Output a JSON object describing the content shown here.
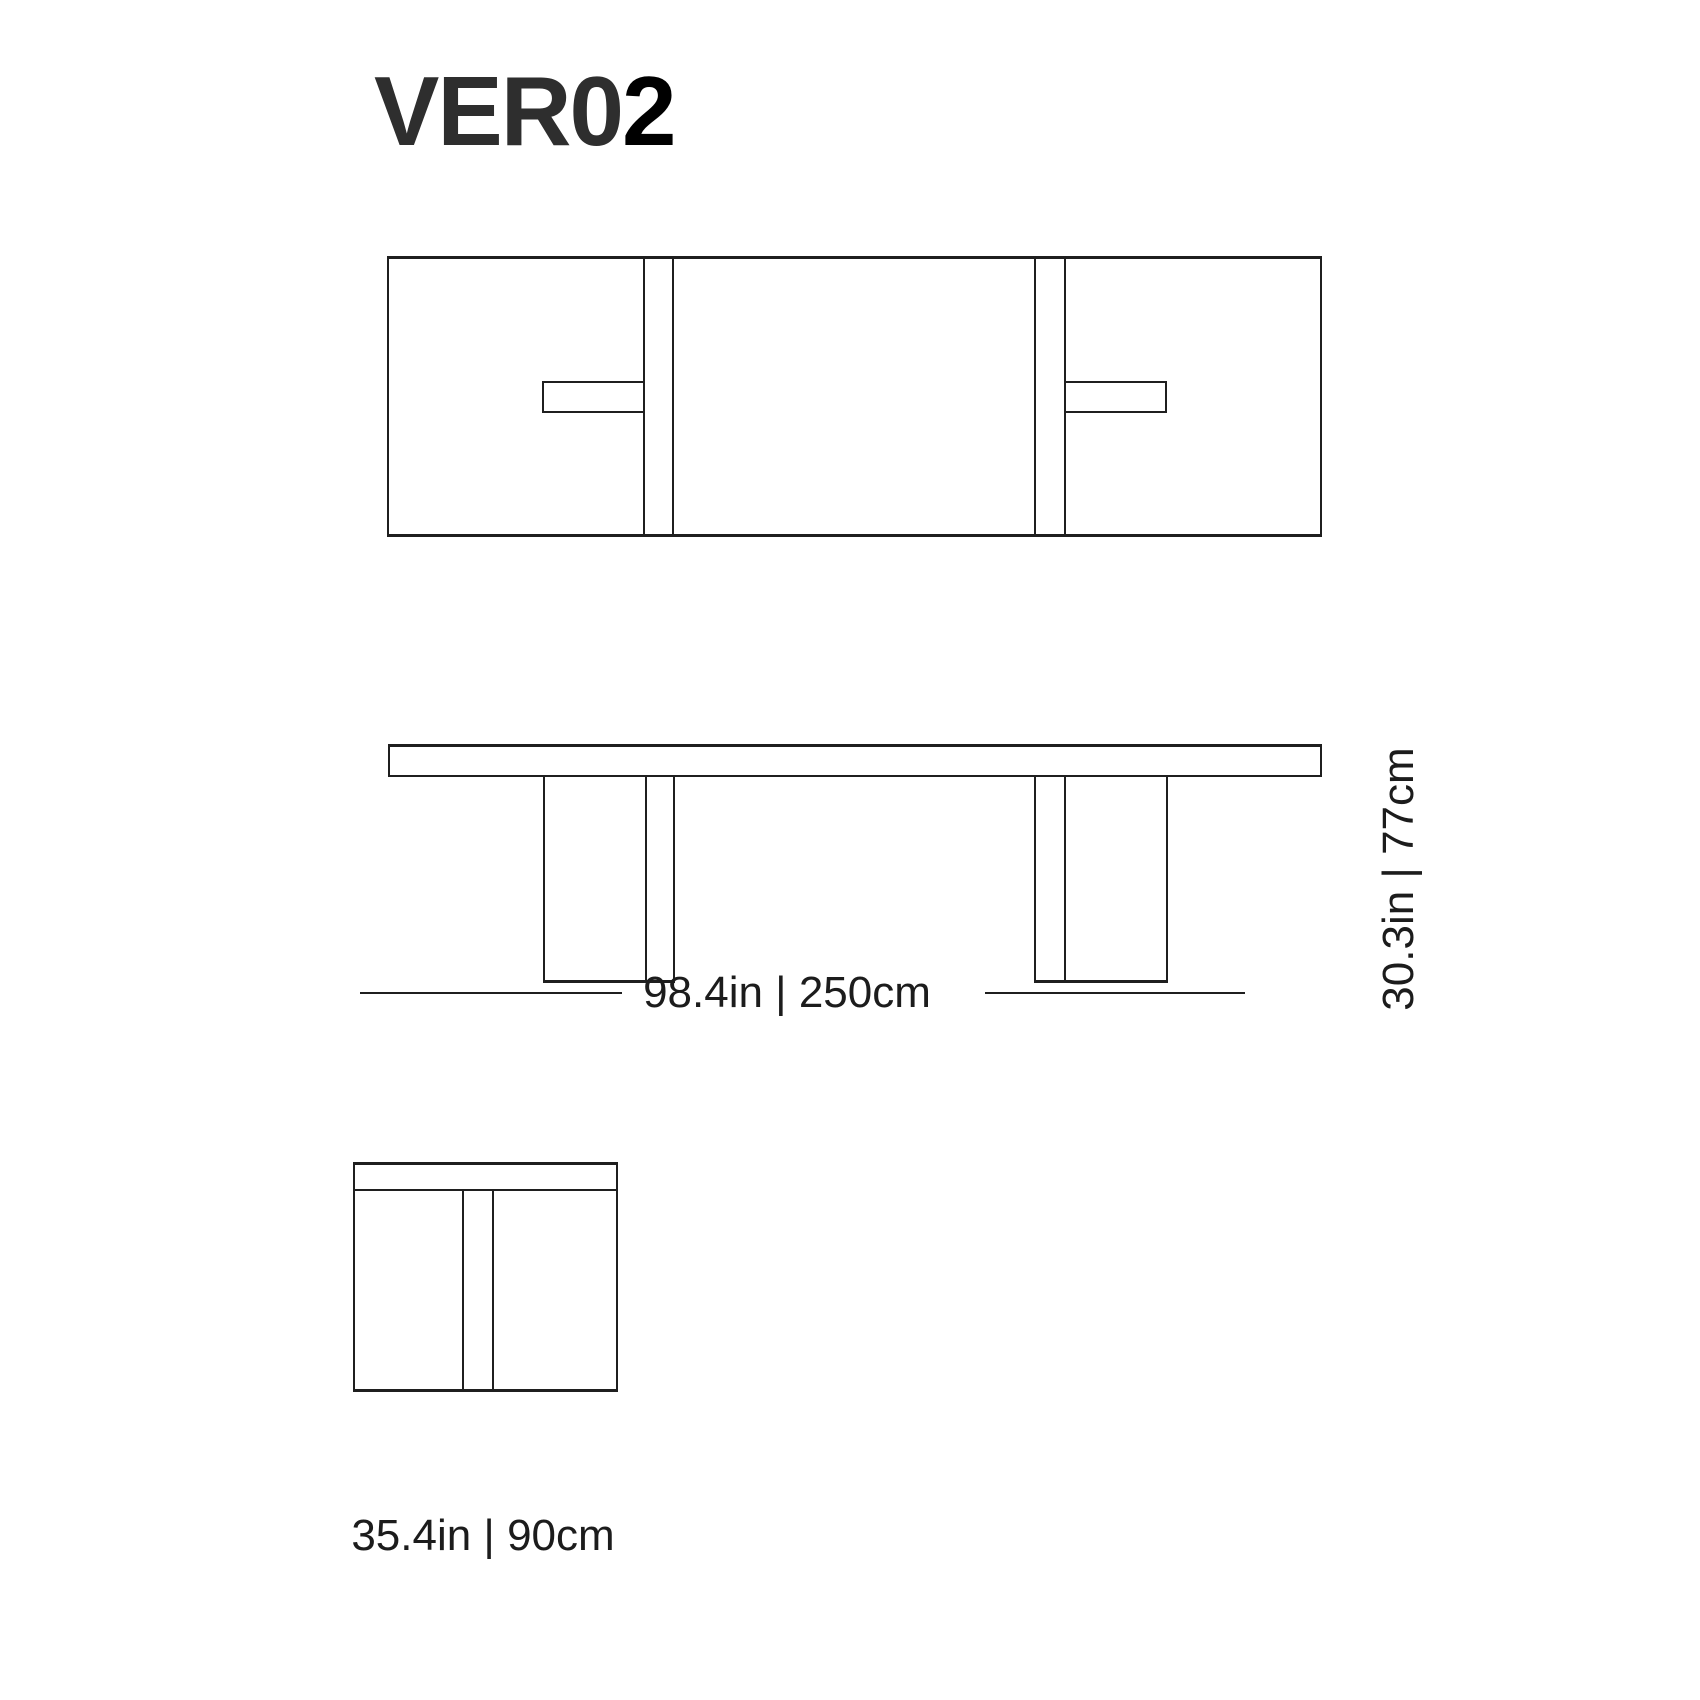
{
  "title": {
    "model_prefix": "VER0",
    "model_suffix": "2",
    "full_model": "VER02"
  },
  "dimensions": {
    "width": {
      "label": "98.4in | 250cm",
      "inches": "98.4in",
      "metric": "250cm"
    },
    "height": {
      "label": "30.3in | 77cm",
      "inches": "30.3in",
      "metric": "77cm"
    },
    "depth": {
      "label": "35.4in | 90cm",
      "inches": "35.4in",
      "metric": "90cm"
    }
  },
  "colors": {
    "background": "#ffffff",
    "line": "#1f1f1f",
    "text": "#1c1c1c",
    "title_prefix": "#2e2e2e",
    "title_suffix": "#000000"
  },
  "views": {
    "plan": "top view of table with two leg plates and perpendicular foot tabs",
    "front": "front elevation with tabletop slab and two composite legs",
    "side": "end view with tabletop edge and leg plate"
  }
}
